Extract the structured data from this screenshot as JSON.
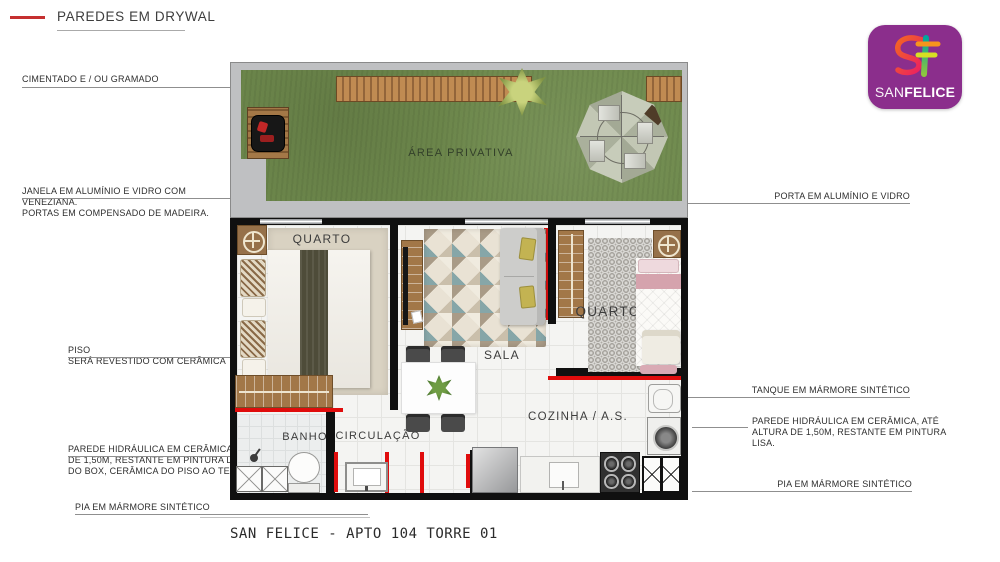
{
  "legend": {
    "label": "PAREDES EM DRYWAL"
  },
  "logo": {
    "brand_prefix": "SAN",
    "brand_suffix": "FELICE",
    "bg_color": "#8b2e8c"
  },
  "footer": {
    "title": "SAN FELICE - APTO 104 TORRE 01"
  },
  "rooms": {
    "area_privativa": "ÁREA PRIVATIVA",
    "quarto_left": "QUARTO",
    "sala": "SALA",
    "quarto_right": "QUARTO",
    "banho": "BANHO",
    "circulacao": "CIRCULAÇÃO",
    "cozinha": "COZINHA / A.S."
  },
  "annotations": {
    "cimentado": {
      "lines": [
        "CIMENTADO E / OU GRAMADO"
      ]
    },
    "janela": {
      "lines": [
        "JANELA EM ALUMÍNIO E VIDRO COM",
        "VENEZIANA.",
        "PORTAS EM COMPENSADO DE MADEIRA."
      ]
    },
    "piso": {
      "lines": [
        "PISO",
        "SERÁ REVESTIDO COM CERÂMICA"
      ]
    },
    "parede_esq": {
      "lines": [
        "PAREDE HIDRÁULICA EM CERÂMICA ATÉ ALTURA",
        "DE 1,50M, RESTANTE EM PINTURA LISA E REGIÃO",
        "DO BOX, CERÂMICA DO PISO AO TETO."
      ]
    },
    "pia_esq": {
      "lines": [
        "PIA EM MÁRMORE SINTÉTICO"
      ]
    },
    "porta": {
      "lines": [
        "PORTA EM ALUMÍNIO E VIDRO"
      ]
    },
    "tanque": {
      "lines": [
        "TANQUE EM MÁRMORE SINTÉTICO"
      ]
    },
    "parede_dir": {
      "lines": [
        "PAREDE HIDRÁULICA EM CERÂMICA, ATÉ",
        "ALTURA DE 1,50M, RESTANTE EM PINTURA",
        "LISA."
      ]
    },
    "pia_dir": {
      "lines": [
        "PIA EM MÁRMORE SINTÉTICO"
      ]
    }
  },
  "colors": {
    "drywall_red": "#e00c0c",
    "legend_red": "#c53030",
    "wall_black": "#101010",
    "grass_green": "#6f8a4d",
    "concrete_gray": "#bfc0c2",
    "logo_purple": "#8b2e8c"
  }
}
